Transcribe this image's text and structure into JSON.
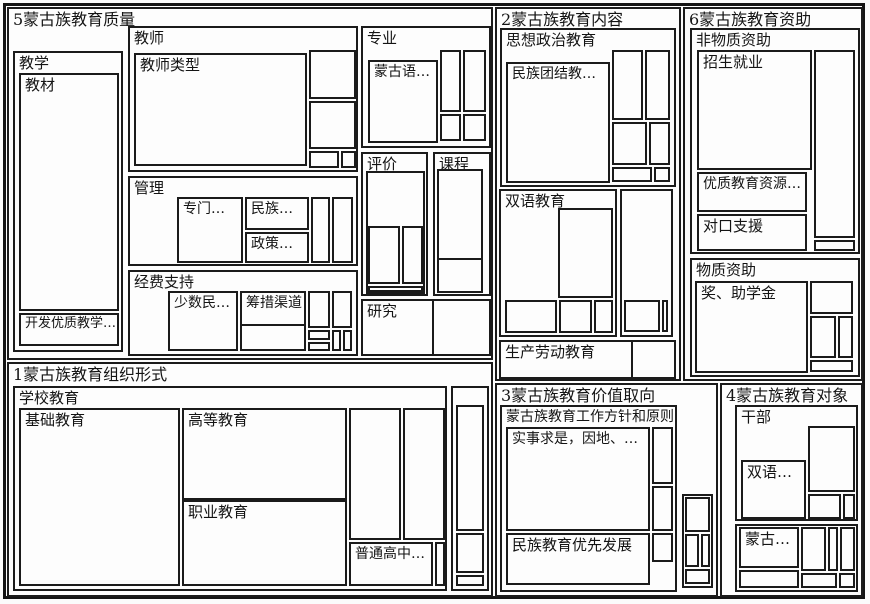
{
  "figure": {
    "type": "treemap-code-map",
    "colors": {
      "background": "#fdfdfd",
      "border": "#1b1b1b",
      "text": "#141414"
    }
  },
  "treemap": {
    "quality": {
      "title": "5蒙古族教育质量",
      "teaching": {
        "title": "教学",
        "textbook": "教材",
        "develop": "开发优质教学…"
      },
      "teacher": {
        "title": "教师",
        "type": "教师类型"
      },
      "management": {
        "title": "管理",
        "special": "专门…",
        "ethnic": "民族…",
        "policy": "政策…"
      },
      "funding": {
        "title": "经费支持",
        "minority": "少数民…",
        "channel": "筹措渠道"
      },
      "major": {
        "title": "专业",
        "mongolian": "蒙古语…"
      },
      "evaluation": {
        "title": "评价"
      },
      "curriculum": {
        "title": "课程"
      },
      "research": {
        "title": "研究"
      }
    },
    "content": {
      "title": "2蒙古族教育内容",
      "ideology": {
        "title": "思想政治教育",
        "unity": "民族团结教…"
      },
      "bilingual": {
        "title": "双语教育"
      },
      "labor": {
        "title": "生产劳动教育"
      }
    },
    "aid": {
      "title": "6蒙古族教育资助",
      "nonmaterial": {
        "title": "非物质资助",
        "enrollment": "招生就业",
        "resources": "优质教育资源…",
        "pairing": "对口支援"
      },
      "material": {
        "title": "物质资助",
        "scholarship": "奖、助学金"
      }
    },
    "organization": {
      "title": "1蒙古族教育组织形式",
      "school": {
        "title": "学校教育",
        "basic": "基础教育",
        "higher": "高等教育",
        "vocational": "职业教育",
        "senior": "普通高中…"
      }
    },
    "values": {
      "title": "3蒙古族教育价值取向",
      "principles": {
        "title": "蒙古族教育工作方针和原则",
        "pragmatic": "实事求是，因地、…",
        "priority": "民族教育优先发展"
      }
    },
    "target": {
      "title": "4蒙古族教育对象",
      "cadre": {
        "title": "干部",
        "bilingual": "双语…"
      },
      "mongolian": "蒙古…"
    }
  }
}
